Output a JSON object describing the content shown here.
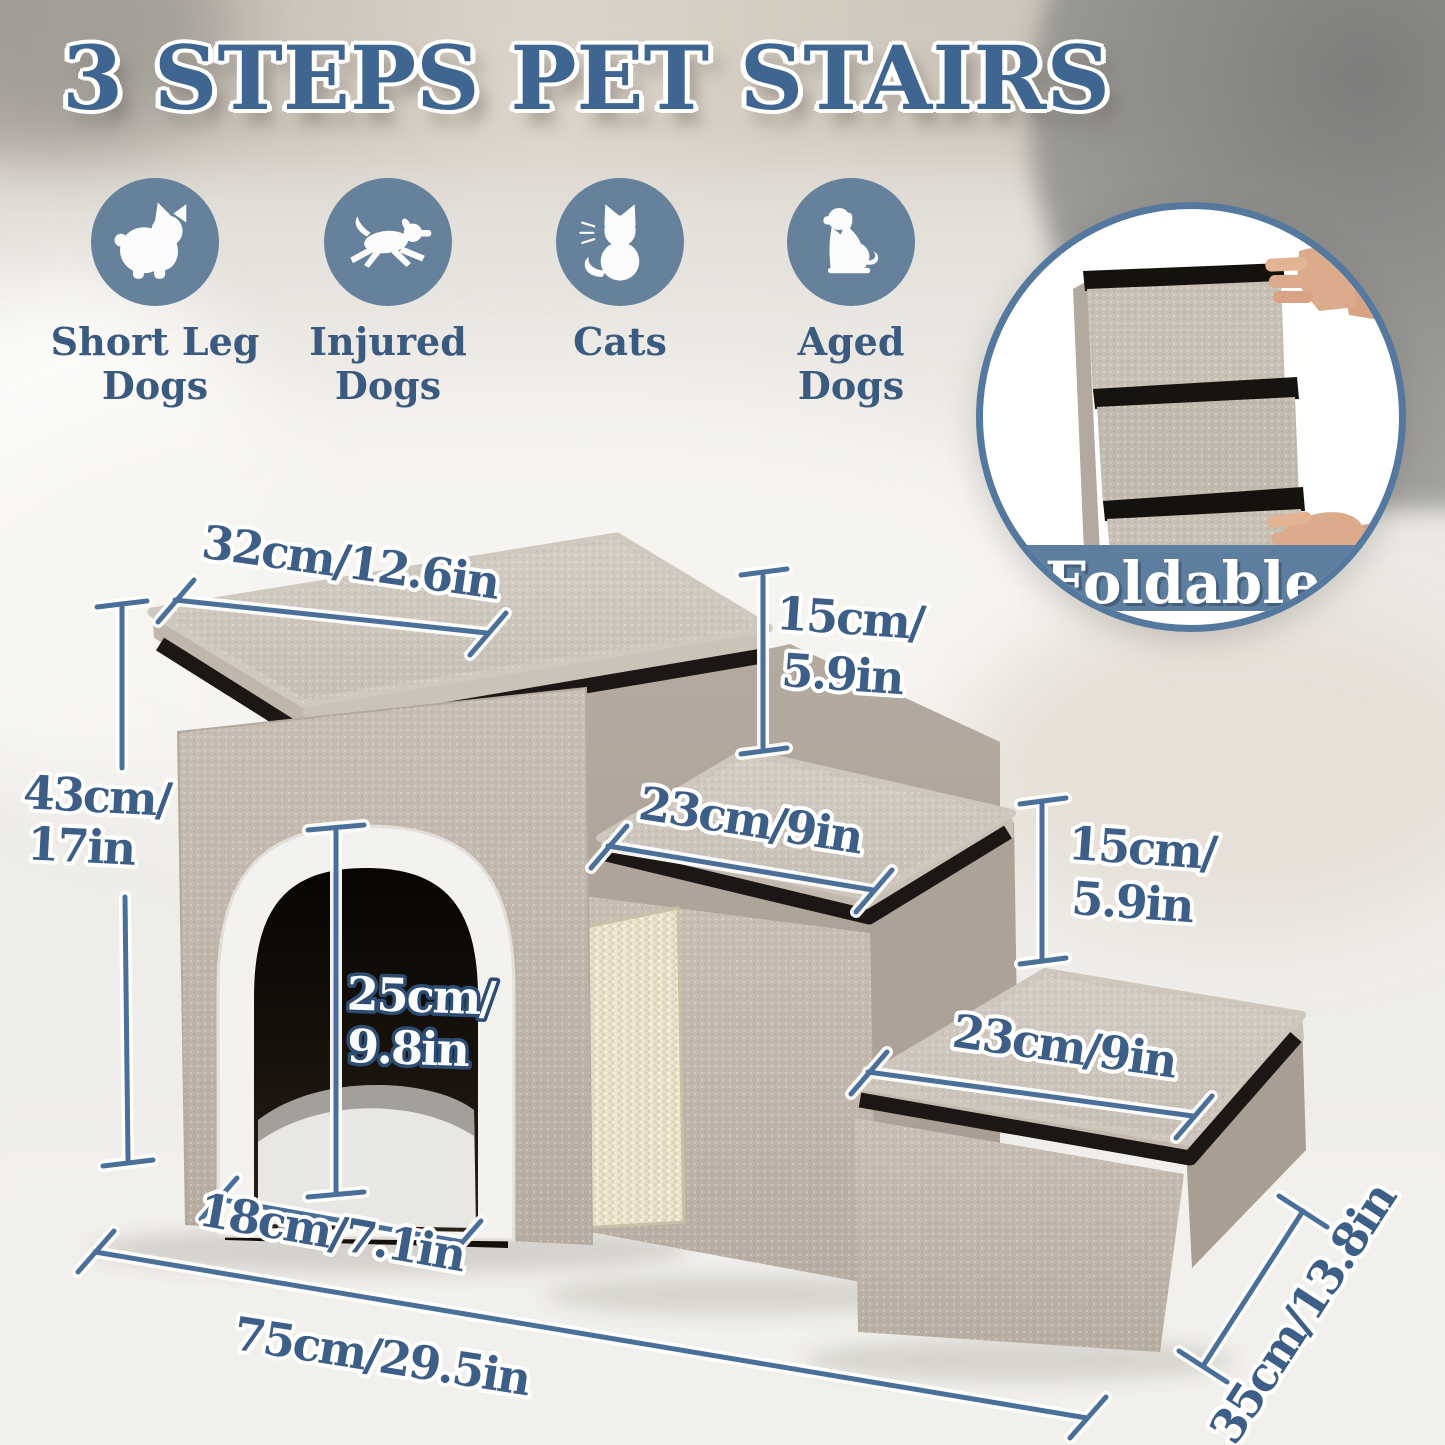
{
  "title": "3 STEPS PET STAIRS",
  "audience": [
    {
      "icon": "short-leg-dog-icon",
      "line1": "Short Leg",
      "line2": "Dogs"
    },
    {
      "icon": "injured-dog-icon",
      "line1": "Injured",
      "line2": "Dogs"
    },
    {
      "icon": "cat-icon",
      "line1": "Cats",
      "line2": ""
    },
    {
      "icon": "aged-dog-icon",
      "line1": "Aged",
      "line2": "Dogs"
    }
  ],
  "foldable_label": "Foldable",
  "dims": {
    "top_width": "32cm/12.6in",
    "riser1_line1": "15cm/",
    "riser1_line2": "5.9in",
    "mid_width": "23cm/9in",
    "riser2_line1": "15cm/",
    "riser2_line2": "5.9in",
    "low_width": "23cm/9in",
    "height_line1": "43cm/",
    "height_line2": "17in",
    "door_height_line1": "25cm/",
    "door_height_line2": "9.8in",
    "door_width": "18cm/7.1in",
    "total_length": "75cm/29.5in",
    "depth": "35cm/13.8in"
  },
  "colors": {
    "title_blue": "#3f6690",
    "icon_circle_blue": "#65819b",
    "label_blue": "#3a5a80",
    "dimension_blue": "#4a6f99",
    "foldable_band_blue": "#5d7e9e",
    "fabric_beige": "#c3b9ae",
    "trim_black": "#1c1714",
    "sisal_cream": "#e7dfc9"
  }
}
